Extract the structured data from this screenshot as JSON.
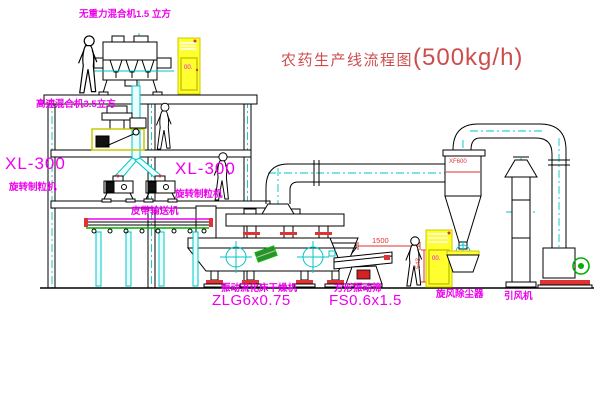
{
  "title": {
    "text": "农药生产线流程图",
    "capacity": "(500kg/h)"
  },
  "labels": {
    "mixer_top": "无重力混合机1.5 立方",
    "mixer_mid": "高速混合机3.5立方",
    "xl300_left": "XL-300",
    "xl300_left_sub": "旋转制粒机",
    "xl300_right": "XL-300",
    "xl300_right_sub": "旋转制粒机",
    "belt_conveyor": "皮带输送机",
    "dryer_name": "振动流化床干燥机",
    "dryer_model": "ZLG6x0.75",
    "screen_name": "方形振动筛",
    "screen_model": "FS0.6x1.5",
    "cyclone": "旋风除尘器",
    "fan": "引风机"
  },
  "annotations": {
    "dim_length": "1500",
    "dim_height": "543",
    "cyclone_tag": "XF600",
    "cabinet1_mark": "00.",
    "cabinet2_mark": "00."
  },
  "colors": {
    "bg": "#ffffff",
    "line": "#000000",
    "magenta": "#ee00ee",
    "title_red": "#cd4d4d",
    "red": "#e03232",
    "cyan": "#00c6c6",
    "cyan_light": "#eaffff",
    "yellow": "#ffff30",
    "yellow_dark": "#c8c800",
    "green": "#00b000"
  }
}
